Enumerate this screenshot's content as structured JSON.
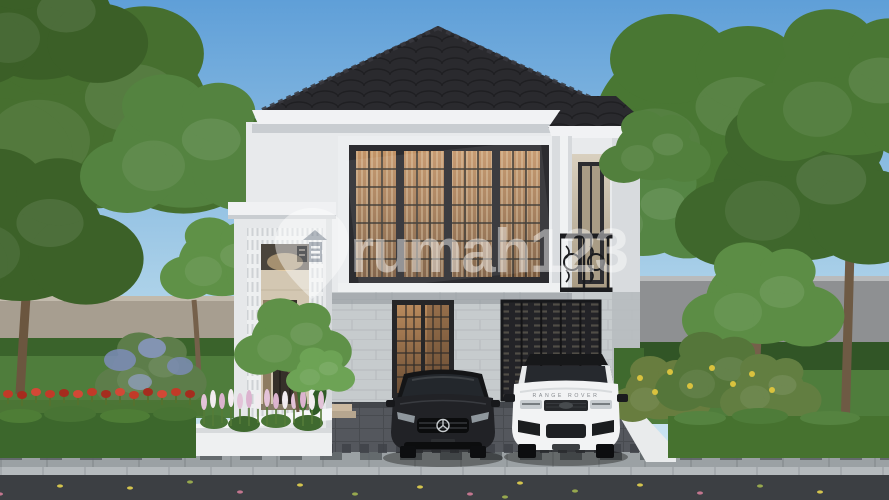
{
  "meta": {
    "type": "architectural-3d-render",
    "subject": "two-story modern classic house exterior with driveway, two cars, garden and street",
    "width": 889,
    "height": 500
  },
  "watermark": {
    "brand": "rumah123",
    "icon": "map-pin-house-icon",
    "color": "#ffffff",
    "opacity": "0.45"
  },
  "vehicles": {
    "sedan": {
      "description": "black sedan",
      "badge": "mercedes-star-icon"
    },
    "suv": {
      "description": "white SUV",
      "hood_text": "RANGE ROVER"
    }
  },
  "house": {
    "roof": "dark tiled hip roof",
    "features": "four-panel window bay, wrought-iron balcony, lattice entry tower, slatted garage door, stone tile ground floor"
  },
  "palette": {
    "sky_top": "#5f9fd8",
    "sky_horizon": "#d6ebf5",
    "roof": "#2a2a2e",
    "fascia": "#f1f2f4",
    "wall_white": "#e8eaec",
    "stone": "#c6cbcd",
    "glass_warm": "#b3885c",
    "grass": "#4f7d3c",
    "hedge": "#3c672c",
    "driveway": "#54575d",
    "sidewalk": "#9ba1a4",
    "curb": "#b5babd",
    "road": "#3c3f43",
    "wall_left": "#a79e90",
    "wall_right": "#8e9092",
    "planter_white": "#eef0f1",
    "flower_red": "#c23a28",
    "flower_pink": "#e3c3d8",
    "flower_yellow": "#d9c23e",
    "car_black": "#212226",
    "car_white": "#f2f3f4"
  }
}
